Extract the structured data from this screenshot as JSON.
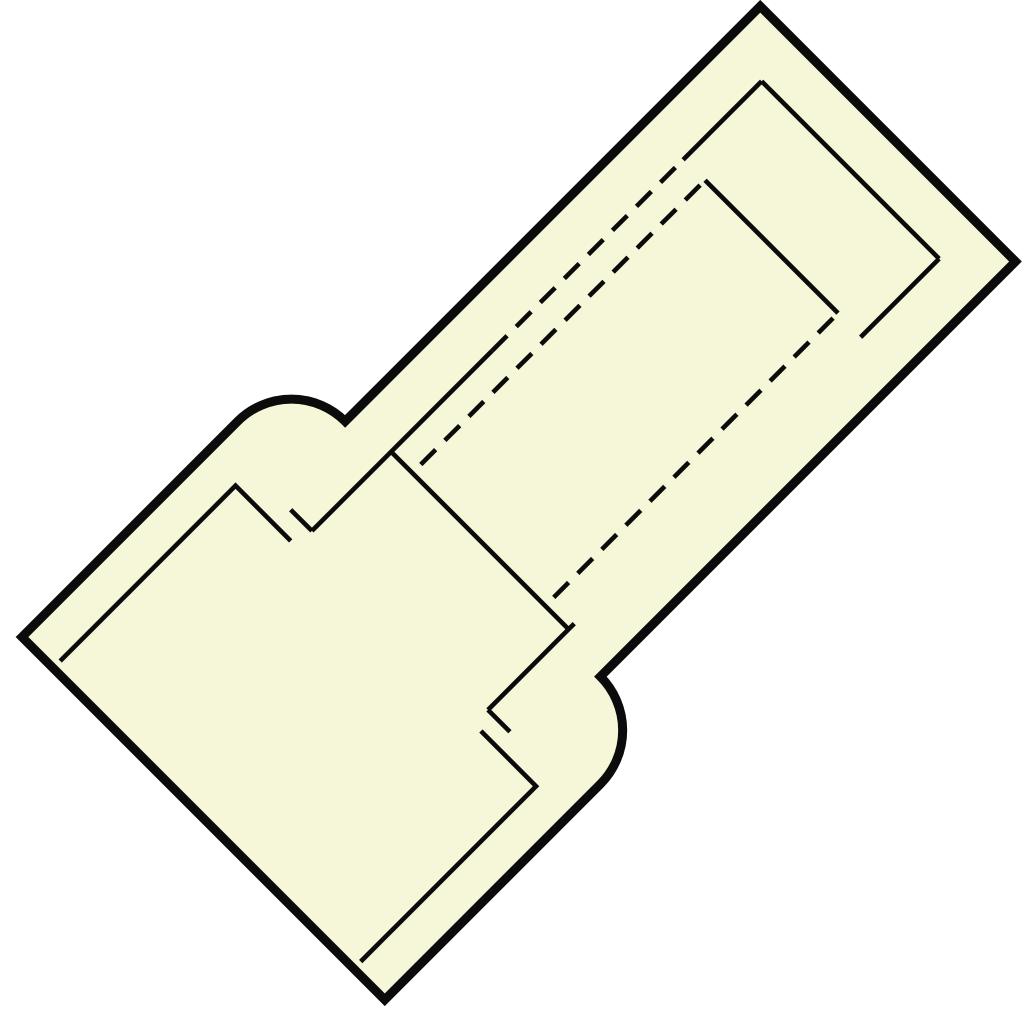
{
  "page": {
    "background_color": "#ffffff"
  },
  "drawing": {
    "description": "technical-line-drawing-insulated-butt-connector",
    "width": 1024,
    "height": 1024,
    "fill_color": "#f6f6d8",
    "line_color": "#0b0b0b",
    "outer_stroke_width": 9,
    "inner_stroke_width": 4.6,
    "dash_pattern": "21 13",
    "transform": {
      "translate_x": 22,
      "translate_y": 637,
      "rotate_deg": -45
    },
    "shapes": [
      {
        "name": "connector-body-outline",
        "kind": "outline",
        "d": "M 0 0 H 305 A 76 76 0 0 1 381 76 H 968 V 437 H 381 A 76 76 0 0 1 305 513 H 0 Z"
      },
      {
        "name": "insulation-wall-top-line",
        "kind": "inner",
        "d": "M 10 44 H 258 V 122"
      },
      {
        "name": "insulation-wall-bottom-line",
        "kind": "inner",
        "d": "M 10 469 H 258 V 391"
      },
      {
        "name": "tube-top-edge-left",
        "kind": "inner",
        "d": "M 280 130 H 535"
      },
      {
        "name": "tube-top-edge-hidden",
        "kind": "inner-dashed",
        "d": "M 535 130 H 805"
      },
      {
        "name": "tube-top-edge-right",
        "kind": "inner",
        "d": "M 805 130 H 916"
      },
      {
        "name": "tube-end-face-right",
        "kind": "inner",
        "d": "M 916 130 V 381"
      },
      {
        "name": "tube-bottom-edge-right",
        "kind": "inner",
        "d": "M 805 381 H 916"
      },
      {
        "name": "tube-bottom-edge-left",
        "kind": "inner",
        "d": "M 278 381 H 400"
      },
      {
        "name": "tube-opening-left-line",
        "kind": "inner",
        "d": "M 392 130 V 381"
      },
      {
        "name": "tube-flare-stub-top",
        "kind": "inner",
        "d": "M 280 130 V 100"
      },
      {
        "name": "tube-flare-stub-bottom",
        "kind": "inner",
        "d": "M 278 381 V 412"
      },
      {
        "name": "bore-hidden-edge-top",
        "kind": "inner-dashed",
        "d": "M 404 160 H 806"
      },
      {
        "name": "bore-hidden-edge-bottom",
        "kind": "inner-dashed",
        "d": "M 404 348 H 806"
      },
      {
        "name": "bore-end-face-line",
        "kind": "inner",
        "d": "M 806 160 V 348"
      }
    ]
  }
}
